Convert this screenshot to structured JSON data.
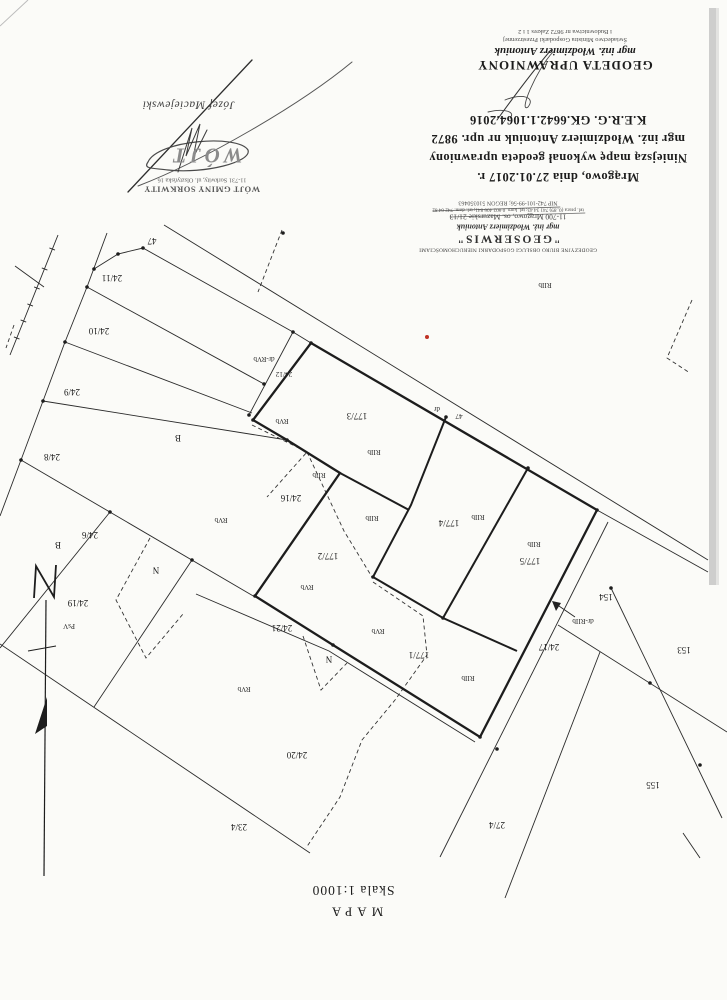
{
  "document": {
    "map_title": "MAPA",
    "scale": "Skala 1:1000"
  },
  "annotations": {
    "date_line": "Mrągowo, dnia 27.01.2017 r.",
    "statement": "Niniejszą mapę wykonał geodeta uprawniony",
    "surveyor": "mgr inż. Włodzimierz Antoniuk nr upr. 9872",
    "kerg": "K.E.R.G. GK.6642.1.1064.2016"
  },
  "stamps": {
    "geodeta": {
      "title": "GEODETA UPRAWNIONY",
      "name": "mgr inż. Włodzimierz Antoniuk",
      "cert1": "Świadectwo Ministra Gospodarki Przestrzennej",
      "cert2": "i Budownictwa nr 9872  Zakres 1 i 2"
    },
    "geoserwis": {
      "line1": "GEODEZYJNE BIURO OBSŁUGI GOSPODARKI NIERUCHOMOŚCIAMI",
      "name": "\"GEOSERWIS\"",
      "person": "mgr inż. Włodzimierz Antoniuk",
      "address": "11-700 Mrągowo, os. Mazurskie 21/13",
      "phones": "tel. praca (0..89) 741 34 43; tel. kom. 0 602 406 841; tel. dom. 742 64 82",
      "nip": "NIP 742-101-99-56; REGON 510350463"
    },
    "wojt": {
      "big": "WÓJT",
      "office": "WÓJT GMINY SORKWITY",
      "address": "11-731 Sorkwity, ul. Olsztyńska 16",
      "signature": "Józef Maciejewski"
    }
  },
  "map": {
    "labels": [
      {
        "text": "47",
        "x": 152,
        "y": 241
      },
      {
        "text": "24/11",
        "x": 112,
        "y": 278
      },
      {
        "text": "24/10",
        "x": 99,
        "y": 331
      },
      {
        "text": "24/9",
        "x": 72,
        "y": 392
      },
      {
        "text": "24/8",
        "x": 52,
        "y": 457
      },
      {
        "text": "B",
        "x": 178,
        "y": 438
      },
      {
        "text": "dr-RVb",
        "x": 264,
        "y": 359,
        "s": "sm"
      },
      {
        "text": "24/12",
        "x": 284,
        "y": 374,
        "s": "sm"
      },
      {
        "text": "RVb",
        "x": 282,
        "y": 421,
        "s": "sm"
      },
      {
        "text": "177/3",
        "x": 357,
        "y": 416
      },
      {
        "text": "RIIb",
        "x": 374,
        "y": 452,
        "s": "sm"
      },
      {
        "text": "RIIb",
        "x": 319,
        "y": 475,
        "s": "sm"
      },
      {
        "text": "24/16",
        "x": 291,
        "y": 498
      },
      {
        "text": "RVb",
        "x": 221,
        "y": 520,
        "s": "sm"
      },
      {
        "text": "dr",
        "x": 437,
        "y": 409,
        "s": "sm"
      },
      {
        "text": "47",
        "x": 459,
        "y": 416,
        "s": "sm"
      },
      {
        "text": "177/4",
        "x": 449,
        "y": 523
      },
      {
        "text": "RIIb",
        "x": 478,
        "y": 517,
        "s": "sm"
      },
      {
        "text": "RIIb",
        "x": 372,
        "y": 518,
        "s": "sm"
      },
      {
        "text": "RIIb",
        "x": 534,
        "y": 544,
        "s": "sm"
      },
      {
        "text": "177/5",
        "x": 530,
        "y": 561
      },
      {
        "text": "154",
        "x": 606,
        "y": 597
      },
      {
        "text": "dr-RIIb",
        "x": 583,
        "y": 621,
        "s": "sm"
      },
      {
        "text": "24/17",
        "x": 549,
        "y": 647
      },
      {
        "text": "153",
        "x": 684,
        "y": 650
      },
      {
        "text": "155",
        "x": 653,
        "y": 785
      },
      {
        "text": "27/4",
        "x": 497,
        "y": 825
      },
      {
        "text": "N",
        "x": 156,
        "y": 570
      },
      {
        "text": "N",
        "x": 329,
        "y": 659
      },
      {
        "text": "24/6",
        "x": 90,
        "y": 535
      },
      {
        "text": "B",
        "x": 58,
        "y": 545
      },
      {
        "text": "24/19",
        "x": 78,
        "y": 603
      },
      {
        "text": "PsV",
        "x": 69,
        "y": 626,
        "s": "sm"
      },
      {
        "text": "177/2",
        "x": 328,
        "y": 556
      },
      {
        "text": "RVb",
        "x": 307,
        "y": 587,
        "s": "sm"
      },
      {
        "text": "24/21",
        "x": 282,
        "y": 628
      },
      {
        "text": "RVb",
        "x": 378,
        "y": 631,
        "s": "sm"
      },
      {
        "text": "177/1",
        "x": 419,
        "y": 655
      },
      {
        "text": "RIIb",
        "x": 468,
        "y": 678,
        "s": "sm"
      },
      {
        "text": "RVb",
        "x": 244,
        "y": 689,
        "s": "sm"
      },
      {
        "text": "24/20",
        "x": 297,
        "y": 755
      },
      {
        "text": "23/4",
        "x": 239,
        "y": 827
      },
      {
        "text": "RIIb",
        "x": 545,
        "y": 285,
        "s": "sm"
      }
    ]
  }
}
